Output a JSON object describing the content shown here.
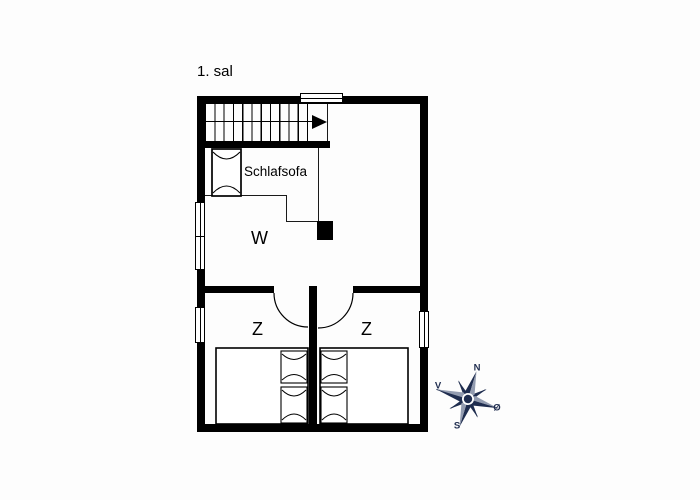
{
  "title": "1. sal",
  "colors": {
    "wall": "#000000",
    "line": "#1a1a1a",
    "compass": "#1f2d4f",
    "compass_light": "#939cb0",
    "background": "#fdfdfd"
  },
  "rooms": {
    "loft": {
      "label": "Schlafsofa"
    },
    "living": {
      "label": "W"
    },
    "bedroom_left": {
      "label": "Z"
    },
    "bedroom_right": {
      "label": "Z"
    }
  },
  "features": {
    "staircase": "staircase-with-up-arrow",
    "chimney": "chimney-block",
    "sofa": "sleep-sofa",
    "beds": [
      "double-bed-left",
      "double-bed-right"
    ],
    "doors": [
      "door-bedroom-left",
      "door-bedroom-right"
    ],
    "windows": [
      "window-top",
      "window-left-upper",
      "window-left-lower",
      "window-right"
    ]
  },
  "compass": {
    "north": "N",
    "west": "V",
    "east": "Ø",
    "south": "S"
  }
}
